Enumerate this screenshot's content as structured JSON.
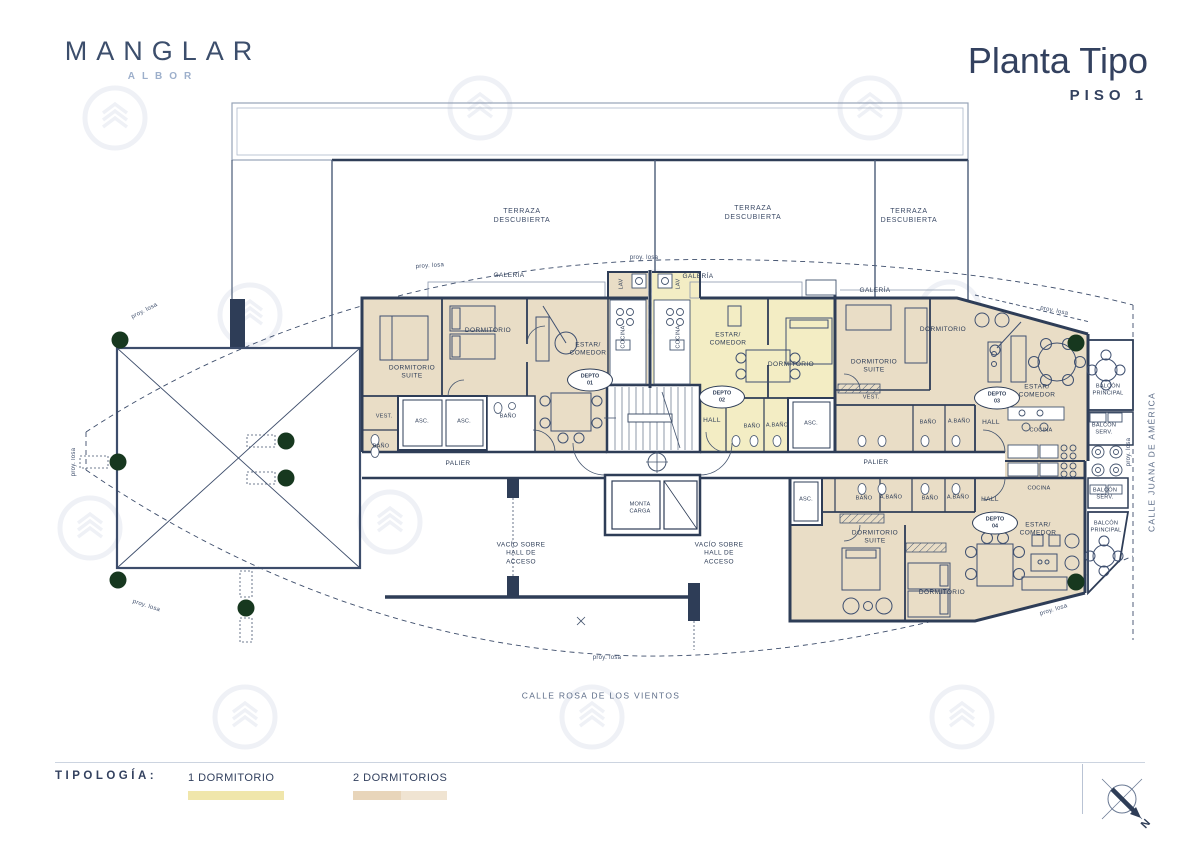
{
  "header": {
    "brand": "MANGLAR",
    "brand_sub": "ALBOR",
    "title": "Planta Tipo",
    "subtitle": "PISO 1"
  },
  "plan": {
    "rooms": {
      "terraza": "TERRAZA\nDESCUBIERTA",
      "galeria": "GALERÍA",
      "proy_losa": "proy. losa",
      "dormitorio": "DORMITORIO",
      "dormitorio_suite": "DORMITORIO\nSUITE",
      "estar_comedor": "ESTAR/\nCOMEDOR",
      "cocina": "COCINA",
      "hall": "HALL",
      "bano": "BAÑO",
      "a_bano": "A.BAÑO",
      "vest": "VEST.",
      "asc": "ASC.",
      "lav": "LAV",
      "palier": "PALIER",
      "monta_carga": "MONTA\nCARGA",
      "vacio": "VACÍO SOBRE\nHALL DE\nACCESO",
      "balcon_principal": "BALCÓN\nPRINCIPAL",
      "balcon_serv": "BALCÓN\nSERV."
    },
    "units": {
      "d01": "DEPTO\n01",
      "d02": "DEPTO\n02",
      "d03": "DEPTO\n03",
      "d04": "DEPTO\n04"
    },
    "streets": {
      "bottom": "CALLE ROSA DE LOS VIENTOS",
      "right": "CALLE JUANA DE AMÉRICA"
    }
  },
  "legend": {
    "title": "TIPOLOGÍA:",
    "items": [
      {
        "label": "1 DORMITORIO",
        "colors": [
          "#f0e6ab"
        ]
      },
      {
        "label": "2 DORMITORIOS",
        "colors": [
          "#e8d5ba",
          "#f0e4d2"
        ]
      }
    ]
  },
  "compass": {
    "north": "N"
  },
  "colors": {
    "wall": "#2e3d57",
    "fill_one_bedroom": "#f3edc4",
    "fill_two_bedroom": "#e9ddc6",
    "tree": "#17381f",
    "brand_navy": "#3c4e6c",
    "brand_light_blue": "#9dafcb"
  }
}
